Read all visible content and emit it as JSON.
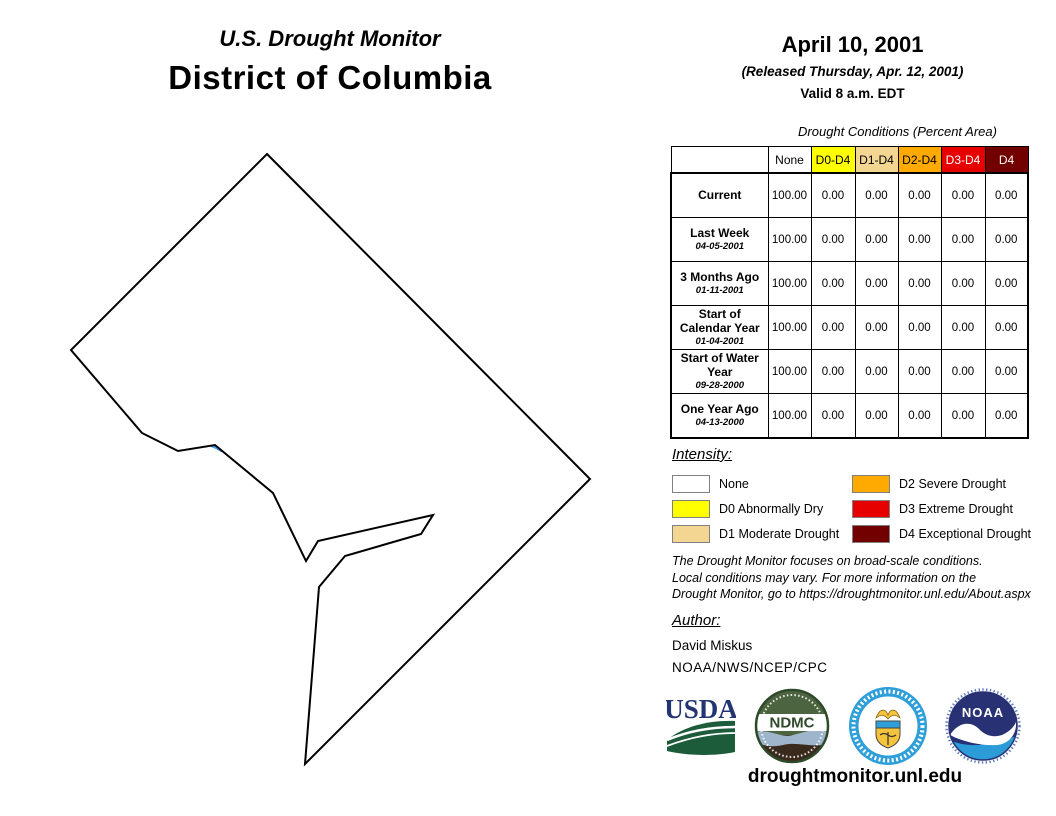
{
  "title": {
    "line1": "U.S. Drought Monitor",
    "line2": "District of Columbia"
  },
  "date_block": {
    "date": "April 10, 2001",
    "released": "(Released Thursday, Apr. 12, 2001)",
    "valid": "Valid 8 a.m. EDT"
  },
  "table": {
    "caption": "Drought Conditions (Percent Area)",
    "columns": [
      "None",
      "D0-D4",
      "D1-D4",
      "D2-D4",
      "D3-D4",
      "D4"
    ],
    "column_colors": {
      "None": "#FFFFFF",
      "D0-D4": "#FFFF00",
      "D1-D4": "#F2D692",
      "D2-D4": "#FFAA00",
      "D3-D4": "#E60000",
      "D4": "#730000"
    },
    "rows": [
      {
        "label": "Current",
        "sublabel": "",
        "values": [
          "100.00",
          "0.00",
          "0.00",
          "0.00",
          "0.00",
          "0.00"
        ]
      },
      {
        "label": "Last Week",
        "sublabel": "04-05-2001",
        "values": [
          "100.00",
          "0.00",
          "0.00",
          "0.00",
          "0.00",
          "0.00"
        ]
      },
      {
        "label": "3 Months Ago",
        "sublabel": "01-11-2001",
        "values": [
          "100.00",
          "0.00",
          "0.00",
          "0.00",
          "0.00",
          "0.00"
        ]
      },
      {
        "label": "Start of Calendar Year",
        "sublabel": "01-04-2001",
        "values": [
          "100.00",
          "0.00",
          "0.00",
          "0.00",
          "0.00",
          "0.00"
        ]
      },
      {
        "label": "Start of Water Year",
        "sublabel": "09-28-2000",
        "values": [
          "100.00",
          "0.00",
          "0.00",
          "0.00",
          "0.00",
          "0.00"
        ]
      },
      {
        "label": "One Year Ago",
        "sublabel": "04-13-2000",
        "values": [
          "100.00",
          "0.00",
          "0.00",
          "0.00",
          "0.00",
          "0.00"
        ]
      }
    ]
  },
  "legend": {
    "heading": "Intensity:",
    "items": [
      {
        "label": "None",
        "color": "#FFFFFF"
      },
      {
        "label": "D0 Abnormally Dry",
        "color": "#FFFF00"
      },
      {
        "label": "D1 Moderate Drought",
        "color": "#F2D692"
      },
      {
        "label": "D2 Severe Drought",
        "color": "#FFAA00"
      },
      {
        "label": "D3 Extreme Drought",
        "color": "#E60000"
      },
      {
        "label": "D4 Exceptional Drought",
        "color": "#730000"
      }
    ]
  },
  "disclaimer": {
    "line1": "The Drought Monitor focuses on broad-scale conditions.",
    "line2": "Local conditions may vary. For more information on the",
    "line3": "Drought Monitor, go to https://droughtmonitor.unl.edu/About.aspx"
  },
  "author": {
    "heading": "Author:",
    "name": "David Miskus",
    "org": "NOAA/NWS/NCEP/CPC"
  },
  "logos": [
    {
      "id": "usda",
      "text": "USDA"
    },
    {
      "id": "ndmc",
      "text": "NDMC"
    },
    {
      "id": "doc-seal",
      "text": ""
    },
    {
      "id": "noaa",
      "text": "NOAA"
    }
  ],
  "footer": {
    "url": "droughtmonitor.unl.edu"
  },
  "map": {
    "region": "District of Columbia",
    "outline_color": "#000000",
    "water_color": "#44A1F2"
  }
}
